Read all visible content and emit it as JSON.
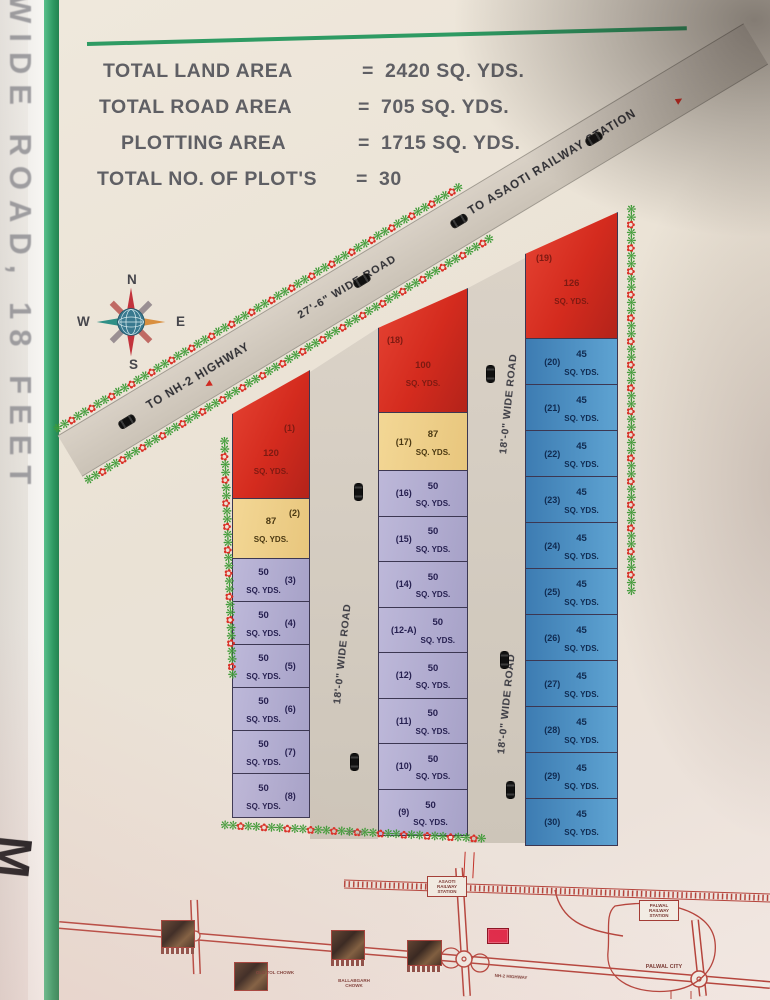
{
  "side": {
    "vertical_text": "WIDE ROAD, 18 FEET",
    "handwriting": "M"
  },
  "summary": [
    {
      "label": "TOTAL LAND AREA",
      "eq": "=",
      "value": "2420 SQ. YDS."
    },
    {
      "label": "TOTAL ROAD AREA",
      "eq": "=",
      "value": "705 SQ. YDS."
    },
    {
      "label": "PLOTTING  AREA",
      "eq": "=",
      "value": "1715 SQ. YDS."
    },
    {
      "label": "TOTAL NO. OF PLOT'S",
      "eq": "=",
      "value": "30"
    }
  ],
  "compass": {
    "north": "N",
    "south": "S",
    "east": "E",
    "west": "W"
  },
  "diagonal_road": {
    "name": "27'-6\" WIDE ROAD",
    "dest_left": "TO NH-2 HIGHWAY",
    "dest_right": "TO ASAOTI RAILWAY STATION"
  },
  "vertical_road_label": "18'-0\" WIDE ROAD",
  "bottom_dimension": "27'-8\"",
  "unit": "SQ. YDS.",
  "columns": [
    {
      "id": "left",
      "plots": [
        {
          "no": "(1)",
          "area": "120",
          "color": "red"
        },
        {
          "no": "(2)",
          "area": "87",
          "color": "yellow"
        },
        {
          "no": "(3)",
          "area": "50",
          "color": "lavender"
        },
        {
          "no": "(4)",
          "area": "50",
          "color": "lavender"
        },
        {
          "no": "(5)",
          "area": "50",
          "color": "lavender"
        },
        {
          "no": "(6)",
          "area": "50",
          "color": "lavender"
        },
        {
          "no": "(7)",
          "area": "50",
          "color": "lavender"
        },
        {
          "no": "(8)",
          "area": "50",
          "color": "lavender"
        }
      ]
    },
    {
      "id": "middle",
      "plots": [
        {
          "no": "(18)",
          "area": "100",
          "color": "red"
        },
        {
          "no": "(17)",
          "area": "87",
          "color": "yellow"
        },
        {
          "no": "(16)",
          "area": "50",
          "color": "lavender"
        },
        {
          "no": "(15)",
          "area": "50",
          "color": "lavender"
        },
        {
          "no": "(14)",
          "area": "50",
          "color": "lavender"
        },
        {
          "no": "(12-A)",
          "area": "50",
          "color": "lavender"
        },
        {
          "no": "(12)",
          "area": "50",
          "color": "lavender"
        },
        {
          "no": "(11)",
          "area": "50",
          "color": "lavender"
        },
        {
          "no": "(10)",
          "area": "50",
          "color": "lavender"
        },
        {
          "no": "(9)",
          "area": "50",
          "color": "lavender"
        }
      ]
    },
    {
      "id": "right",
      "plots": [
        {
          "no": "(19)",
          "area": "126",
          "color": "red"
        },
        {
          "no": "(20)",
          "area": "45",
          "color": "blue"
        },
        {
          "no": "(21)",
          "area": "45",
          "color": "blue"
        },
        {
          "no": "(22)",
          "area": "45",
          "color": "blue"
        },
        {
          "no": "(23)",
          "area": "45",
          "color": "blue"
        },
        {
          "no": "(24)",
          "area": "45",
          "color": "blue"
        },
        {
          "no": "(25)",
          "area": "45",
          "color": "blue"
        },
        {
          "no": "(26)",
          "area": "45",
          "color": "blue"
        },
        {
          "no": "(27)",
          "area": "45",
          "color": "blue"
        },
        {
          "no": "(28)",
          "area": "45",
          "color": "blue"
        },
        {
          "no": "(29)",
          "area": "45",
          "color": "blue"
        },
        {
          "no": "(30)",
          "area": "45",
          "color": "blue"
        }
      ]
    }
  ],
  "route_map": {
    "labels": {
      "station_left": "ASAOTI RAILWAY STATION",
      "station_right": "PALWAL RAILWAY STATION",
      "chowk_mid": "OLD TOL CHOWK",
      "chowk_right": "BALLABGARH CHOWK",
      "city": "PALWAL CITY",
      "highway": "NH-2 HIGHWAY"
    }
  },
  "colors": {
    "plot_red": "#d42b1e",
    "plot_yellow": "#eecf90",
    "plot_lavender": "#b3aed2",
    "plot_blue": "#4a8ec4",
    "road_fill": "#d7cfc4",
    "garland_green": "#3f9b37",
    "garland_red": "#da2f26",
    "map_line": "#b5443c",
    "frame_green": "#2e9b63"
  }
}
